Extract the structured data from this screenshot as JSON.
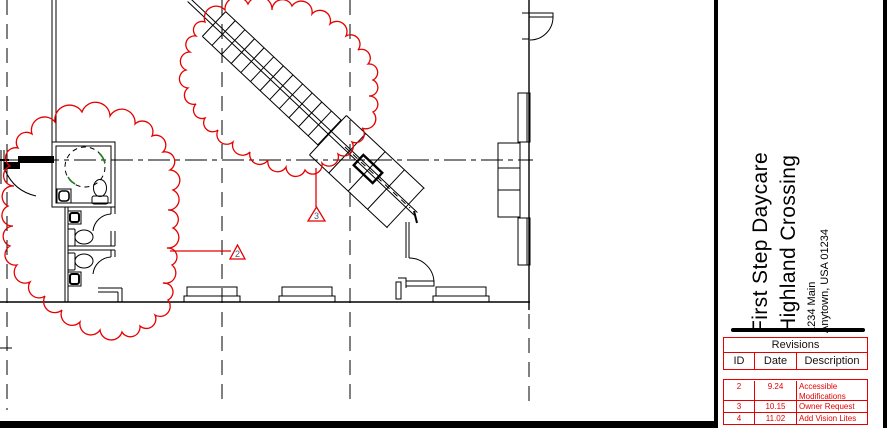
{
  "title_block": {
    "project_name_line1": "First Step Daycare",
    "project_name_line2": "Highland Crossing",
    "address_line1": "1234 Main",
    "address_line2": "Anytown, USA 01234"
  },
  "revisions": {
    "title": "Revisions",
    "columns": {
      "id": "ID",
      "date": "Date",
      "description": "Description"
    },
    "rows": [
      {
        "id": "2",
        "date": "9.24",
        "description": "Accessible Modifications"
      },
      {
        "id": "3",
        "date": "10.15",
        "description": "Owner Request"
      },
      {
        "id": "4",
        "date": "11.02",
        "description": "Add Vision Lites"
      }
    ]
  },
  "plan_markers": {
    "revision_triangle_lower": "2",
    "revision_triangle_upper": "3"
  },
  "colors": {
    "revision_red": "#e60000",
    "line_black": "#000000",
    "accent_green": "#1d7a1d"
  }
}
